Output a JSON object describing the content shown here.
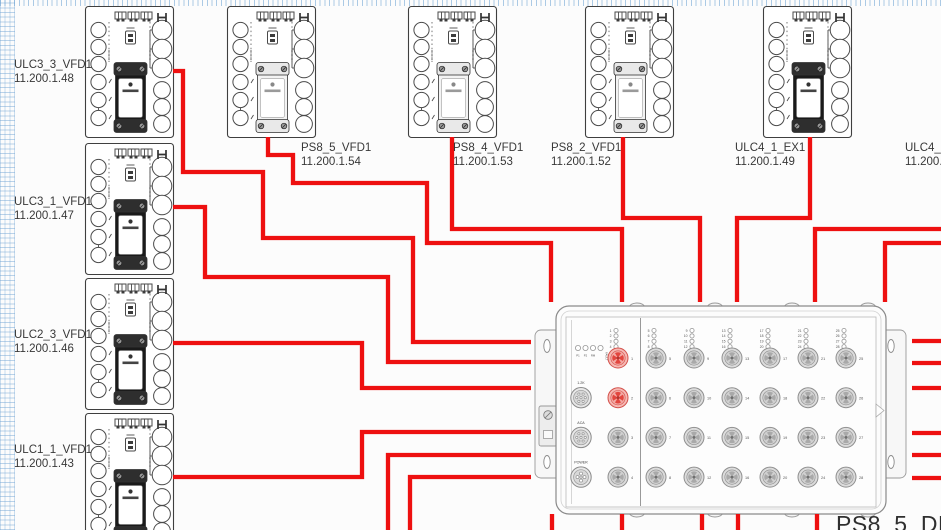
{
  "canvas": {
    "width": 941,
    "height": 530,
    "background": "#fcfcfc",
    "grid_color": "#69a0d2",
    "wire_color": "#ee1010"
  },
  "devices": [
    {
      "name": "ULC3_3_VFD1",
      "ip": "11.200.1.48",
      "x": 85,
      "y": 6,
      "variant": "dark",
      "label_x": 14,
      "label_y": 59
    },
    {
      "name": "ULC3_1_VFD1",
      "ip": "11.200.1.47",
      "x": 85,
      "y": 143,
      "variant": "dark",
      "label_x": 14,
      "label_y": 196
    },
    {
      "name": "ULC2_3_VFD1",
      "ip": "11.200.1.46",
      "x": 85,
      "y": 278,
      "variant": "dark",
      "label_x": 14,
      "label_y": 329
    },
    {
      "name": "ULC1_1_VFD1",
      "ip": "11.200.1.43",
      "x": 85,
      "y": 413,
      "variant": "dark",
      "label_x": 14,
      "label_y": 444
    },
    {
      "name": "PS8_5_VFD1",
      "ip": "11.200.1.54",
      "x": 227,
      "y": 6,
      "variant": "light",
      "label_x": 301,
      "label_y": 142
    },
    {
      "name": "PS8_4_VFD1",
      "ip": "11.200.1.53",
      "x": 408,
      "y": 6,
      "variant": "light",
      "label_x": 453,
      "label_y": 142
    },
    {
      "name": "PS8_2_VFD1",
      "ip": "11.200.1.52",
      "x": 585,
      "y": 6,
      "variant": "light",
      "label_x": 551,
      "label_y": 142
    },
    {
      "name": "ULC4_1_EX1",
      "ip": "11.200.1.49",
      "x": 763,
      "y": 6,
      "variant": "dark",
      "label_x": 735,
      "label_y": 142
    }
  ],
  "offscreen_labels": [
    {
      "name": "ULC4_3_",
      "ip": "11.200.1",
      "label_x": 905,
      "label_y": 142
    }
  ],
  "module": {
    "label": "PS8_5_DRM1",
    "status_leds": [
      "P1",
      "P2",
      "RM",
      "FAULT"
    ],
    "aux_connectors": [
      "1.2K",
      "ACA",
      "POWER"
    ],
    "port_count": 28,
    "port_columns": 7,
    "port_rows": 4,
    "highlighted_ports": [
      1,
      2
    ],
    "highlight_color": "#e2463f"
  },
  "wires": [
    {
      "from": "ULC3_3_VFD1",
      "points": [
        [
          173,
          71
        ],
        [
          183,
          71
        ],
        [
          183,
          172
        ],
        [
          263,
          172
        ],
        [
          263,
          238
        ],
        [
          413,
          238
        ],
        [
          413,
          342
        ],
        [
          531,
          342
        ]
      ]
    },
    {
      "from": "ULC3_1_VFD1",
      "points": [
        [
          173,
          207
        ],
        [
          205,
          207
        ],
        [
          205,
          277
        ],
        [
          388,
          277
        ],
        [
          388,
          362
        ],
        [
          531,
          362
        ]
      ]
    },
    {
      "from": "ULC2_3_VFD1",
      "points": [
        [
          173,
          343
        ],
        [
          362,
          343
        ],
        [
          362,
          388
        ],
        [
          531,
          388
        ]
      ]
    },
    {
      "from": "ULC1_1_VFD1",
      "points": [
        [
          173,
          477
        ],
        [
          362,
          477
        ],
        [
          362,
          432
        ],
        [
          531,
          432
        ]
      ]
    },
    {
      "from": "PS8_5_VFD1",
      "points": [
        [
          268,
          137
        ],
        [
          268,
          155
        ],
        [
          293,
          155
        ],
        [
          293,
          183
        ],
        [
          427,
          183
        ],
        [
          427,
          243
        ],
        [
          551,
          243
        ],
        [
          551,
          302
        ]
      ]
    },
    {
      "from": "PS8_4_VFD1",
      "points": [
        [
          452,
          137
        ],
        [
          452,
          229
        ],
        [
          622,
          229
        ],
        [
          622,
          302
        ]
      ]
    },
    {
      "from": "PS8_2_VFD1",
      "points": [
        [
          623,
          137
        ],
        [
          623,
          218
        ],
        [
          700,
          218
        ],
        [
          700,
          302
        ]
      ]
    },
    {
      "from": "ULC4_1_EX1",
      "points": [
        [
          810,
          137
        ],
        [
          810,
          218
        ],
        [
          737,
          218
        ],
        [
          737,
          302
        ]
      ]
    },
    {
      "from": "right-edge-1",
      "points": [
        [
          941,
          229
        ],
        [
          815,
          229
        ],
        [
          815,
          302
        ]
      ]
    },
    {
      "from": "right-edge-2",
      "points": [
        [
          941,
          243
        ],
        [
          885,
          243
        ],
        [
          885,
          302
        ]
      ]
    },
    {
      "from": "module-left-down-1",
      "points": [
        [
          531,
          455
        ],
        [
          388,
          455
        ],
        [
          388,
          531
        ]
      ]
    },
    {
      "from": "module-left-down-2",
      "points": [
        [
          531,
          477
        ],
        [
          410,
          477
        ],
        [
          410,
          531
        ]
      ]
    },
    {
      "from": "module-bottom-1",
      "points": [
        [
          552,
          514
        ],
        [
          552,
          531
        ]
      ]
    },
    {
      "from": "module-bottom-2",
      "points": [
        [
          622,
          514
        ],
        [
          622,
          531
        ]
      ]
    },
    {
      "from": "module-bottom-3",
      "points": [
        [
          702,
          514
        ],
        [
          702,
          531
        ]
      ]
    },
    {
      "from": "module-bottom-4",
      "points": [
        [
          738,
          514
        ],
        [
          738,
          531
        ]
      ]
    },
    {
      "from": "module-bottom-5",
      "points": [
        [
          817,
          514
        ],
        [
          817,
          531
        ]
      ]
    },
    {
      "from": "module-right-1",
      "points": [
        [
          912,
          341
        ],
        [
          941,
          341
        ]
      ]
    },
    {
      "from": "module-right-2",
      "points": [
        [
          912,
          363
        ],
        [
          941,
          363
        ]
      ]
    },
    {
      "from": "module-right-3",
      "points": [
        [
          912,
          388
        ],
        [
          941,
          388
        ]
      ]
    },
    {
      "from": "module-right-4",
      "points": [
        [
          912,
          433
        ],
        [
          941,
          433
        ]
      ]
    },
    {
      "from": "module-right-5",
      "points": [
        [
          912,
          455
        ],
        [
          941,
          455
        ]
      ]
    },
    {
      "from": "module-right-6",
      "points": [
        [
          912,
          478
        ],
        [
          941,
          478
        ]
      ]
    }
  ]
}
